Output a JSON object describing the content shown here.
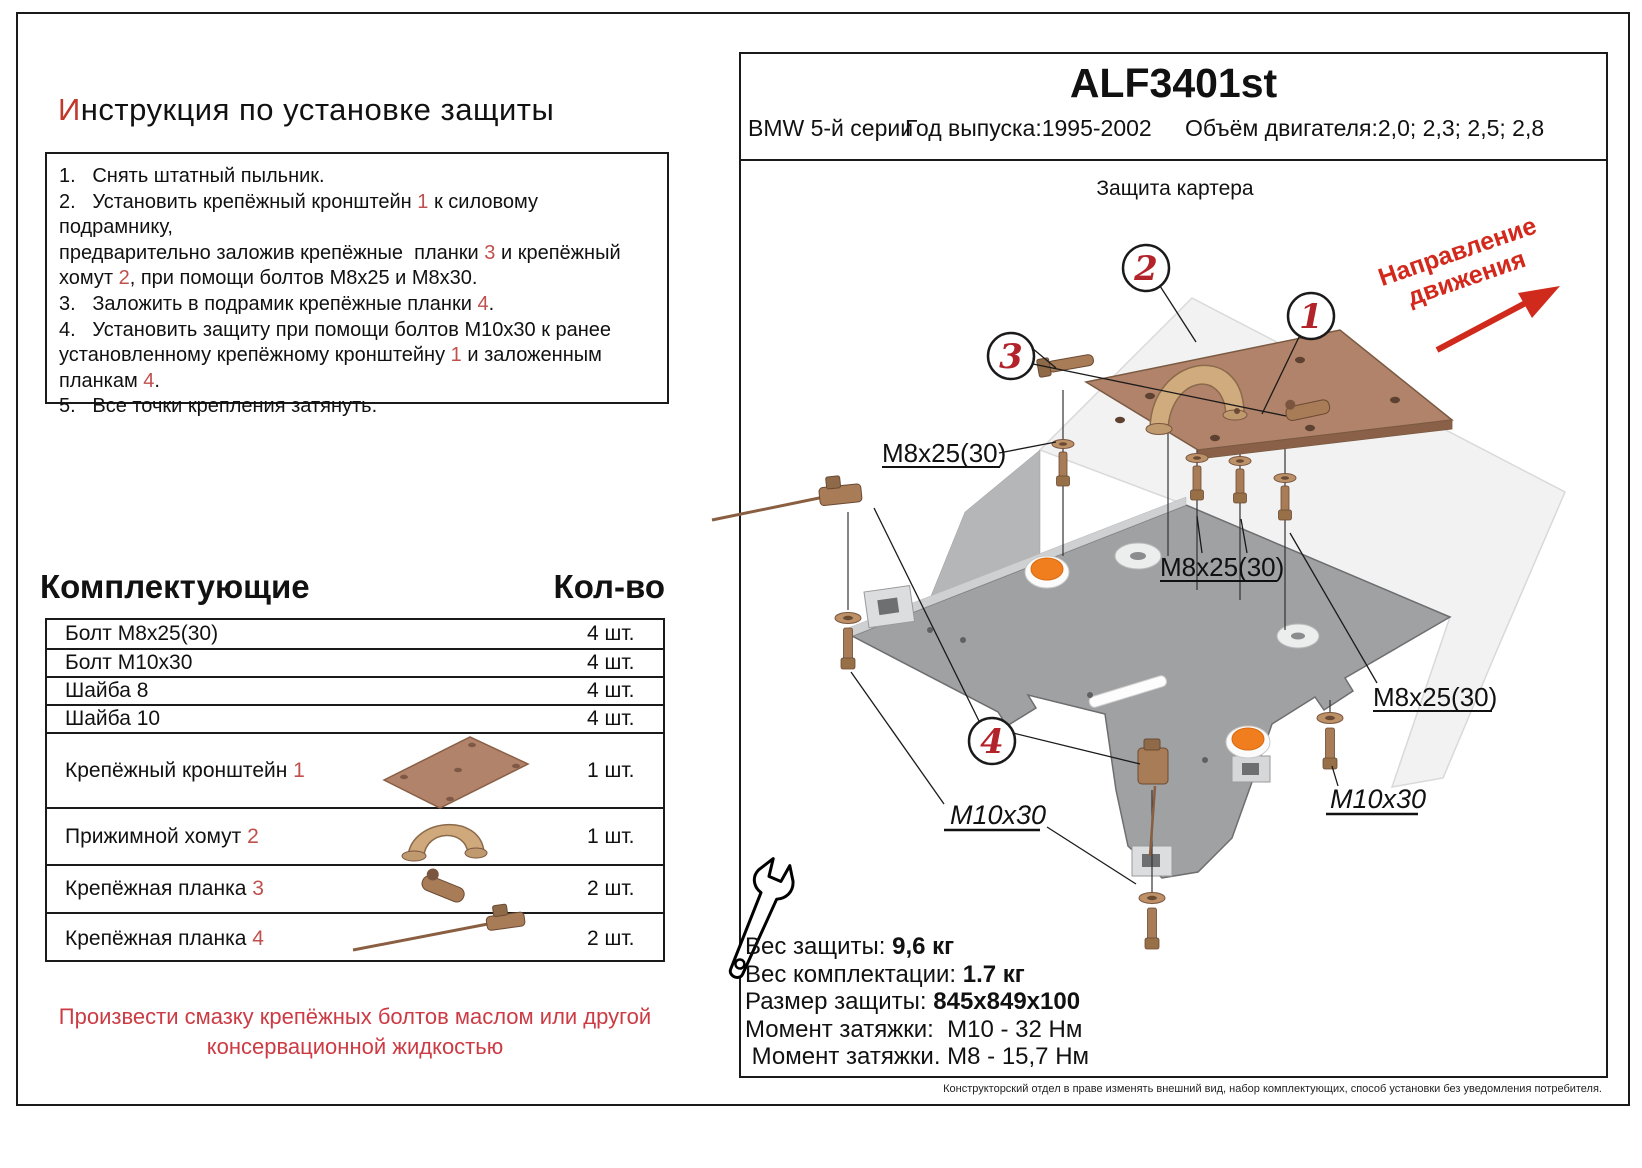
{
  "left": {
    "title": {
      "first_letter": "И",
      "rest": "нструкция по установке защиты"
    },
    "instructions": [
      [
        {
          "t": "1.   Снять штатный пыльник."
        }
      ],
      [
        {
          "t": "2.   Установить крепёжный кронштейн "
        },
        {
          "t": "1",
          "red": true
        },
        {
          "t": " к силовому подрамнику,"
        }
      ],
      [
        {
          "t": "предварительно заложив крепёжные  планки "
        },
        {
          "t": "3",
          "red": true
        },
        {
          "t": " и крепёжный"
        }
      ],
      [
        {
          "t": "хомут "
        },
        {
          "t": "2",
          "red": true
        },
        {
          "t": ", при помощи болтов М8х25 и М8х30."
        }
      ],
      [
        {
          "t": "3.   Заложить в подрамик крепёжные планки "
        },
        {
          "t": "4",
          "red": true
        },
        {
          "t": "."
        }
      ],
      [
        {
          "t": "4.   Установить защиту при помощи болтов М10х30 к ранее"
        }
      ],
      [
        {
          "t": "установленному крепёжному кронштейну "
        },
        {
          "t": "1",
          "red": true
        },
        {
          "t": " и заложенным"
        }
      ],
      [
        {
          "t": "планкам "
        },
        {
          "t": "4",
          "red": true
        },
        {
          "t": "."
        }
      ],
      [
        {
          "t": "5.   Все точки крепления затянуть."
        }
      ]
    ],
    "components_header": {
      "title": "Комплектующие",
      "qty": "Кол-во"
    },
    "components": [
      {
        "name": "Болт М8х25(30)",
        "num": "",
        "qty": "4 шт."
      },
      {
        "name": "Болт М10х30",
        "num": "",
        "qty": "4 шт."
      },
      {
        "name": "Шайба 8",
        "num": "",
        "qty": "4 шт."
      },
      {
        "name": "Шайба 10",
        "num": "",
        "qty": "4 шт."
      },
      {
        "name": "Крепёжный кронштейн ",
        "num": "1",
        "qty": "1 шт."
      },
      {
        "name": "Прижимной хомут ",
        "num": "2",
        "qty": "1 шт."
      },
      {
        "name": "Крепёжная планка ",
        "num": "3",
        "qty": "2 шт."
      },
      {
        "name": "Крепёжная планка ",
        "num": "4",
        "qty": "2 шт."
      }
    ],
    "footer_note_line1": "Произвести смазку крепёжных болтов маслом или другой",
    "footer_note_line2": "консервационной жидкостью"
  },
  "right": {
    "part_code": "ALF3401st",
    "car": "BMW 5-й серии",
    "year_label": "Год выпуска:1995-2002",
    "engine_label": "Объём двигателя:2,0; 2,3; 2,5; 2,8",
    "diagram_title": "Защита картера",
    "direction_line1": "Направление",
    "direction_line2": "движения",
    "callouts": {
      "c1": "1",
      "c2": "2",
      "c3": "3",
      "c4": "4"
    },
    "labels": {
      "m8_1": "М8х25(30)",
      "m8_2": "М8х25(30)",
      "m8_3": "M8x25(30)",
      "m10_left": "M10x30",
      "m10_right": "M10x30"
    },
    "info": [
      {
        "label": "Вес защиты: ",
        "value": "9,6 кг"
      },
      {
        "label": "Вес комплектации: ",
        "value": "1.7 кг"
      },
      {
        "label": "Размер защиты: ",
        "value": "845х849х100"
      },
      {
        "label": "Момент затяжки:  М10 - 32 Нм",
        "value": ""
      },
      {
        "label": " Момент затяжки. М8 - 15,7 Нм",
        "value": ""
      }
    ],
    "disclaimer": "Конструкторский отдел в праве изменять внешний вид, набор комплектующих, способ установки без уведомления потребителя."
  },
  "colors": {
    "red_accent": "#c0504d",
    "callout_red": "#b3242a",
    "direction_red": "#d3281c",
    "copper": "#b1836a",
    "plate_gray": "#9fa1a3",
    "orange": "#f07e1e"
  }
}
